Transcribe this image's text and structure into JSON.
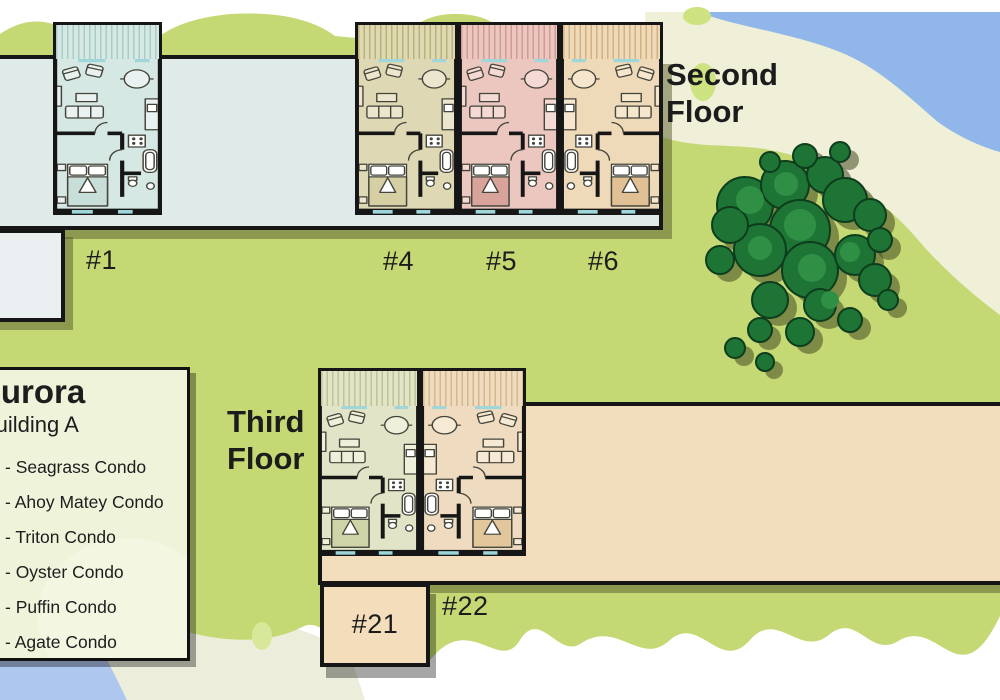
{
  "map_title": "Condo building floor plan map",
  "titles": {
    "second_floor": "Second Floor",
    "third_floor": "Third Floor"
  },
  "legend": {
    "title": "Aurora",
    "subtitle": "Building A",
    "items": [
      "- Seagrass Condo",
      "- Ahoy Matey Condo",
      "- Triton Condo",
      "- Oyster Condo",
      "- Puffin Condo",
      "- Agate Condo"
    ]
  },
  "units": [
    {
      "label": "#1",
      "floor": "second",
      "fill": "#d6e8e4",
      "accent": "#a9ccc6",
      "furn": "#e9f2f0",
      "bed": "#c7ded9"
    },
    {
      "label": "#4",
      "floor": "second",
      "fill": "#ded9b4",
      "accent": "#bab273",
      "furn": "#ebe6cd",
      "bed": "#d6cfa4"
    },
    {
      "label": "#5",
      "floor": "second",
      "fill": "#ecc7c0",
      "accent": "#cf9d94",
      "furn": "#f4d9d4",
      "bed": "#d8a39a"
    },
    {
      "label": "#6",
      "floor": "second",
      "fill": "#eed9b8",
      "accent": "#d2b184",
      "furn": "#f5e6cd",
      "bed": "#e0c094"
    },
    {
      "label": "#21",
      "floor": "third",
      "fill": "#e1e4c6",
      "accent": "#bfc395",
      "furn": "#eef0da",
      "bed": "#cfd3a8"
    },
    {
      "label": "#22",
      "floor": "third",
      "fill": "#efdcc0",
      "accent": "#d4b78c",
      "furn": "#f6ead4",
      "bed": "#e2c79d"
    }
  ],
  "palette": {
    "grass": "#c4d974",
    "grass_blob": "#cde280",
    "sand": "#f0efd8",
    "water_top": "#90b6ea",
    "water_bottom": "#aec7ef",
    "building_interior": "#e0eae9",
    "wing_interior": "#eaf0f1",
    "wall": "#161616",
    "tan_block": "#f2debc",
    "tree_green": "#1e7434",
    "tree_light": "#2f9045",
    "window_teal": "#9fd6da",
    "legend_bg": "#eef3da"
  }
}
